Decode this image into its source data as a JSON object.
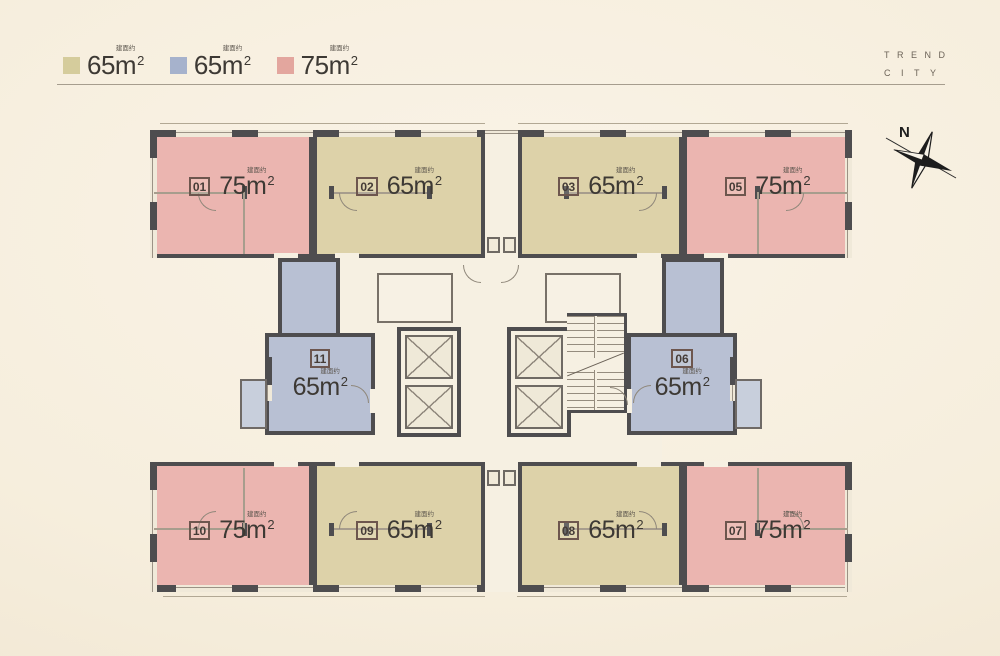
{
  "header": {
    "brand_line1": "TREND",
    "brand_line2": "CITY"
  },
  "compass": {
    "label": "N"
  },
  "labels": {
    "prefix": "建面约",
    "m": "m",
    "sup": "2"
  },
  "legend": {
    "items": [
      {
        "label": "65",
        "swatch": "#d5cc9c"
      },
      {
        "label": "65",
        "swatch": "#a6b2cc"
      },
      {
        "label": "75",
        "swatch": "#e3a69e"
      }
    ]
  },
  "colors": {
    "pink": "#ebb5b0",
    "tan": "#ddd2a9",
    "blue": "#b8c0d3",
    "balcony": "#c8cfdc"
  },
  "plan": {
    "units": [
      {
        "id": "01",
        "area": "75",
        "color": "#ebb5b0"
      },
      {
        "id": "02",
        "area": "65",
        "color": "#ddd2a9"
      },
      {
        "id": "03",
        "area": "65",
        "color": "#ddd2a9"
      },
      {
        "id": "05",
        "area": "75",
        "color": "#ebb5b0"
      },
      {
        "id": "11",
        "area": "65",
        "color": "#b8c0d3"
      },
      {
        "id": "06",
        "area": "65",
        "color": "#b8c0d3"
      },
      {
        "id": "10",
        "area": "75",
        "color": "#ebb5b0"
      },
      {
        "id": "09",
        "area": "65",
        "color": "#ddd2a9"
      },
      {
        "id": "08",
        "area": "65",
        "color": "#ddd2a9"
      },
      {
        "id": "07",
        "area": "75",
        "color": "#ebb5b0"
      }
    ]
  }
}
